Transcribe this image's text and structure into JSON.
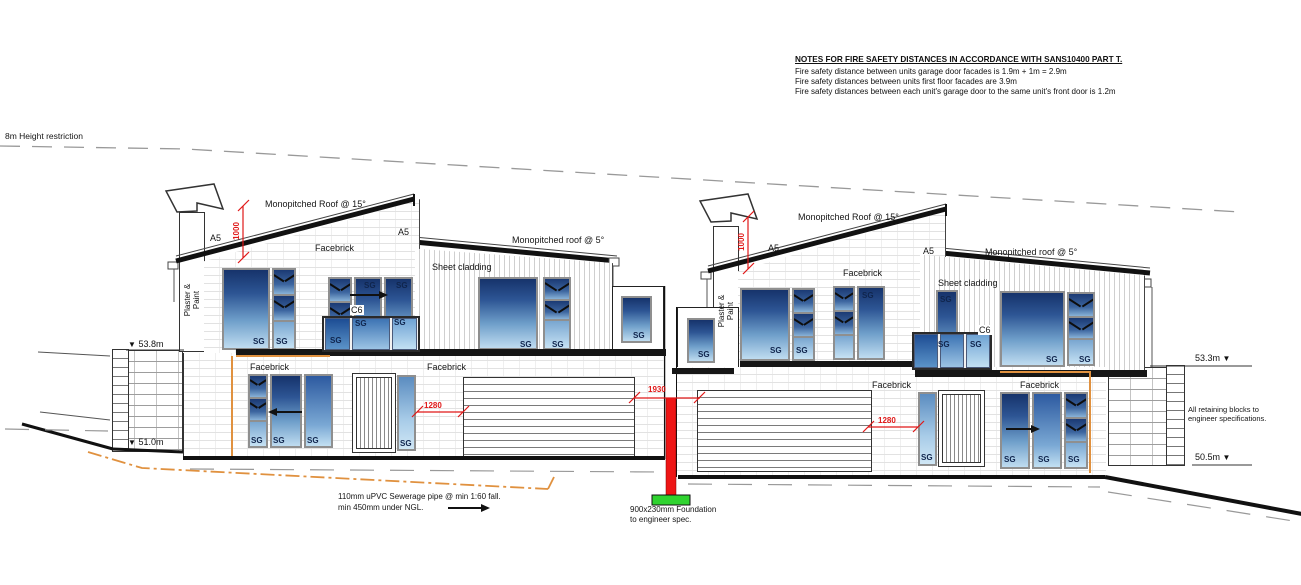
{
  "notes": {
    "heading": "NOTES FOR FIRE SAFETY DISTANCES IN ACCORDANCE WITH SANS10400 PART T.",
    "lines": [
      "Fire safety distance between units garage door facades is 1.9m + 1m = 2.9m",
      "Fire safety distances between units first floor facades are 3.9m",
      "Fire safety distances between each unit's garage door to the same unit's front door is 1.2m"
    ]
  },
  "site": {
    "height_restriction": "8m Height restriction",
    "levels": {
      "left_upper": "53.8m",
      "left_lower": "51.0m",
      "right_upper": "53.3m",
      "right_lower": "50.5m"
    },
    "retaining_note_line1": "All retaining blocks to",
    "retaining_note_line2": "engineer specifications.",
    "sewer_note_line1": "110mm uPVC Sewerage pipe @ min 1:60 fall.",
    "sewer_note_line2": "min 450mm under NGL.",
    "foundation_note_line1": "900x230mm Foundation",
    "foundation_note_line2": "to engineer spec."
  },
  "labels": {
    "roof15": "Monopitched Roof @ 15°",
    "roof5": "Monopitched roof @ 5°",
    "facebrick": "Facebrick",
    "sheet_cladding": "Sheet cladding",
    "plaster_paint": "Plaster & Paint",
    "a5": "A5",
    "c6": "C6",
    "sg": "SG"
  },
  "dimensions": {
    "roof_offset": "1000",
    "garage_side": "1280",
    "between_units": "1930"
  },
  "icons": {
    "level_marker": "▼"
  },
  "colors": {
    "dimension_red": "#e01818",
    "foundation_red": "#ee1515",
    "foundation_green": "#2fd32f",
    "sewer_orange": "#e0913f",
    "glass_dark": "#16336b",
    "glass_light": "#bfdcf0"
  }
}
